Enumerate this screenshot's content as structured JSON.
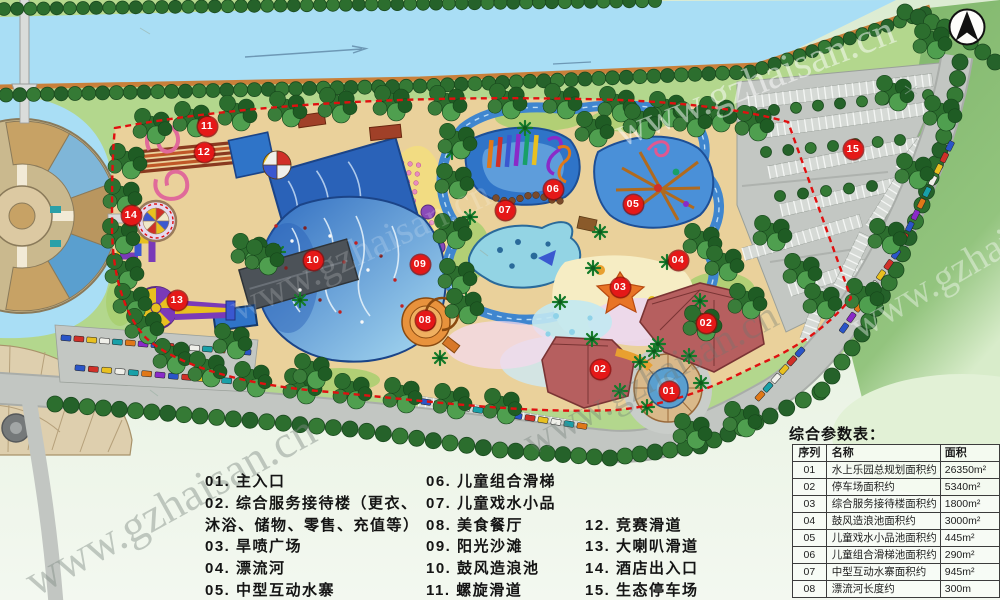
{
  "watermark": {
    "text": "www.gzhaisan.cn"
  },
  "legend": {
    "columns": [
      {
        "items": [
          "01. 主入口",
          "02. 综合服务接待楼（更衣、",
          "沐浴、储物、零售、充值等）",
          "03. 旱喷广场",
          "04. 漂流河",
          "05. 中型互动水寨"
        ]
      },
      {
        "items": [
          "06. 儿童组合滑梯",
          "07. 儿童戏水小品",
          "08. 美食餐厅",
          "09. 阳光沙滩",
          "10. 鼓风造浪池",
          "11. 螺旋滑道"
        ]
      },
      {
        "items": [
          "12. 竞赛滑道",
          "13. 大喇叭滑道",
          "14. 酒店出入口",
          "15. 生态停车场"
        ]
      }
    ]
  },
  "table": {
    "title": "综合参数表：",
    "headers": [
      "序列",
      "名称",
      "面积"
    ],
    "rows": [
      [
        "01",
        "水上乐园总规划面积约",
        "26350m²"
      ],
      [
        "02",
        "停车场面积约",
        "5340m²"
      ],
      [
        "03",
        "综合服务接待楼面积约",
        "1800m²"
      ],
      [
        "04",
        "鼓风造浪池面积约",
        "3000m²"
      ],
      [
        "05",
        "儿童戏水小品池面积约",
        "445m²"
      ],
      [
        "06",
        "儿童组合滑梯池面积约",
        "290m²"
      ],
      [
        "07",
        "中型互动水寨面积约",
        "945m²"
      ],
      [
        "08",
        "漂流河长度约",
        "300m"
      ]
    ]
  },
  "map": {
    "marker_color": "#e51818",
    "boundary_color": "#e01010",
    "markers": [
      {
        "label": "01",
        "x": 669,
        "y": 391
      },
      {
        "label": "02",
        "x": 706,
        "y": 323
      },
      {
        "label": "02",
        "x": 600,
        "y": 369
      },
      {
        "label": "03",
        "x": 620,
        "y": 287
      },
      {
        "label": "04",
        "x": 678,
        "y": 260
      },
      {
        "label": "05",
        "x": 633,
        "y": 204
      },
      {
        "label": "06",
        "x": 553,
        "y": 189
      },
      {
        "label": "07",
        "x": 505,
        "y": 210
      },
      {
        "label": "08",
        "x": 425,
        "y": 320
      },
      {
        "label": "09",
        "x": 420,
        "y": 264
      },
      {
        "label": "10",
        "x": 313,
        "y": 260
      },
      {
        "label": "11",
        "x": 207,
        "y": 126
      },
      {
        "label": "12",
        "x": 204,
        "y": 152
      },
      {
        "label": "13",
        "x": 177,
        "y": 300
      },
      {
        "label": "14",
        "x": 131,
        "y": 215
      },
      {
        "label": "15",
        "x": 853,
        "y": 149
      }
    ]
  }
}
